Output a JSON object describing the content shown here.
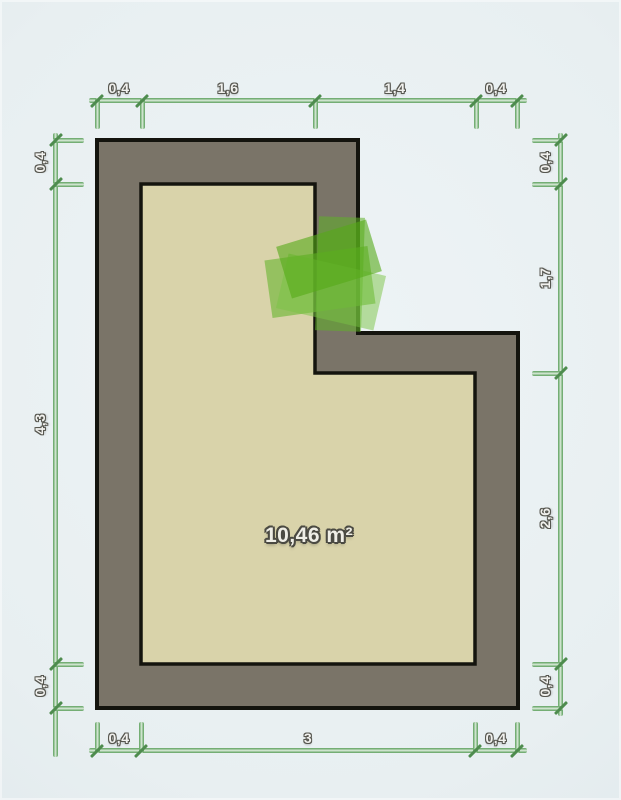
{
  "scene": {
    "type": "floor-plan-editor-canvas",
    "background_color": "#e8eff1"
  },
  "room": {
    "area_label": "10,46 m²",
    "wall_color": "#7a7468",
    "floor_color": "#d9d3aa",
    "outline_color": "#14140e",
    "area_label_center": {
      "x": 309,
      "y": 536
    },
    "outer_polygon": [
      [
        97,
        140
      ],
      [
        358,
        140
      ],
      [
        358,
        333
      ],
      [
        518,
        333
      ],
      [
        518,
        708
      ],
      [
        97,
        708
      ]
    ],
    "inner_polygon": [
      [
        141,
        184
      ],
      [
        315,
        184
      ],
      [
        315,
        373
      ],
      [
        475,
        373
      ],
      [
        475,
        664
      ],
      [
        141,
        664
      ]
    ]
  },
  "green_object": {
    "label": "green-item",
    "parts": [
      {
        "cx": 320,
        "cy": 282,
        "w": 104,
        "h": 58,
        "rot": -8,
        "color": "#67b52f",
        "opacity": 0.6
      },
      {
        "cx": 340,
        "cy": 274,
        "w": 46,
        "h": 114,
        "rot": 2,
        "color": "#5fb026",
        "opacity": 0.55
      },
      {
        "cx": 331,
        "cy": 292,
        "w": 100,
        "h": 56,
        "rot": 13,
        "color": "#7ac344",
        "opacity": 0.5
      },
      {
        "cx": 329,
        "cy": 259,
        "w": 94,
        "h": 54,
        "rot": -17,
        "color": "#55aa18",
        "opacity": 0.6
      }
    ]
  },
  "dimensions": {
    "line_color": "#74ae74",
    "slash_color": "#4e8c4e",
    "top": {
      "line": {
        "x1": 89,
        "x2": 527,
        "y": 100
      },
      "ticks": [
        97,
        142,
        315,
        476,
        517
      ],
      "labels": [
        {
          "text": "0,4",
          "pos": 119
        },
        {
          "text": "1,6",
          "pos": 228
        },
        {
          "text": "1,4",
          "pos": 395
        },
        {
          "text": "0,4",
          "pos": 496
        }
      ]
    },
    "bottom": {
      "line": {
        "x1": 89,
        "x2": 527,
        "y": 750
      },
      "ticks": [
        97,
        141,
        475,
        517
      ],
      "labels": [
        {
          "text": "0,4",
          "pos": 119
        },
        {
          "text": "3",
          "pos": 308
        },
        {
          "text": "0,4",
          "pos": 496
        }
      ]
    },
    "left": {
      "line": {
        "y1": 133,
        "y2": 757,
        "x": 55
      },
      "ticks": [
        140,
        184,
        664,
        708
      ],
      "labels": [
        {
          "text": "0,4",
          "pos": 162
        },
        {
          "text": "4,3",
          "pos": 424
        },
        {
          "text": "0,4",
          "pos": 686
        }
      ]
    },
    "right": {
      "line": {
        "y1": 133,
        "y2": 716,
        "x": 560
      },
      "ticks": [
        140,
        184,
        373,
        664,
        708
      ],
      "labels": [
        {
          "text": "0,4",
          "pos": 162
        },
        {
          "text": "1,7",
          "pos": 278
        },
        {
          "text": "2,6",
          "pos": 518
        },
        {
          "text": "0,4",
          "pos": 686
        }
      ]
    }
  }
}
